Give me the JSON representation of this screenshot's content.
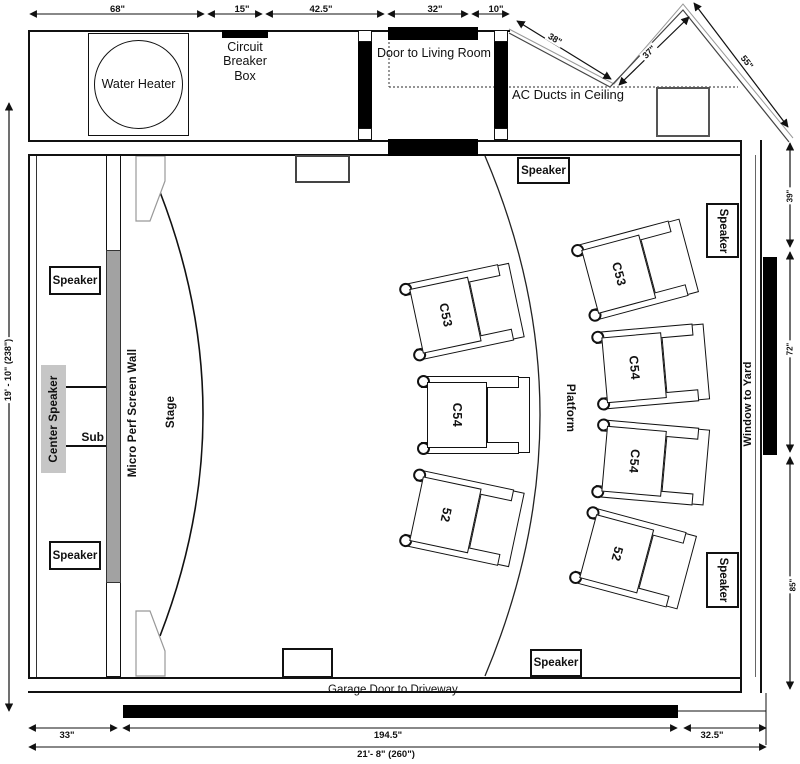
{
  "labels": {
    "water_heater": "Water Heater",
    "circuit_breaker_box": "Circuit Breaker Box",
    "door_to_living_room": "Door to Living Room",
    "ac_ducts": "AC Ducts in Ceiling",
    "speaker": "Speaker",
    "center_speaker": "Center Speaker",
    "sub": "Sub",
    "micro_perf_screen_wall": "Micro Perf Screen Wall",
    "stage": "Stage",
    "platform": "Platform",
    "window_to_yard": "Window to Yard",
    "garage_door": "Garage Door to Driveway"
  },
  "dimensions": {
    "top": [
      "68\"",
      "15\"",
      "42.5\"",
      "32\"",
      "10\""
    ],
    "diagonal": [
      "38\"",
      "37\"",
      "55\""
    ],
    "bottom": [
      "33\"",
      "194.5\"",
      "32.5\""
    ],
    "total_width": "21'- 8\" (260\")",
    "left_height": "19' - 10\" (238\")",
    "right": [
      "39\"",
      "72\"",
      "85\""
    ]
  },
  "seats": {
    "front_row": [
      "C53",
      "C54",
      "52"
    ],
    "back_row": [
      "C53",
      "C54",
      "C54",
      "52"
    ]
  },
  "colors": {
    "line": "#111111",
    "screen_wall_gray": "#a2a2a2",
    "center_speaker_gray": "#c6c6c6",
    "black": "#000000"
  }
}
